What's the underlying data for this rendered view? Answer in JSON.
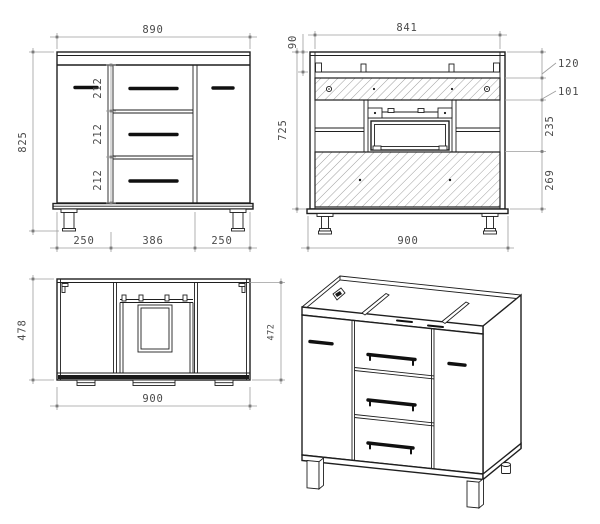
{
  "page": {
    "background": "#ffffff"
  },
  "style": {
    "line_color": "#1f1f1f",
    "dim_line_color": "#9c9c9c",
    "dim_text_color": "#4a4a4a",
    "handle_color": "#101010"
  },
  "views": {
    "front": {
      "name": "front-elevation",
      "dims": {
        "width_top": "890",
        "height_overall": "825",
        "drawer_1": "212",
        "drawer_2": "212",
        "drawer_3": "212",
        "bottom_left": "250",
        "bottom_center": "386",
        "bottom_right": "250"
      }
    },
    "rear": {
      "name": "rear-elevation",
      "dims": {
        "width_inner_top": "841",
        "top_rail": "90",
        "height_side": "725",
        "leader_1": "120",
        "leader_2": "101",
        "mid_section": "235",
        "lower_panel": "269",
        "width_overall": "900"
      }
    },
    "top": {
      "name": "plan-view",
      "dims": {
        "depth_overall": "478",
        "depth_inner": "472",
        "width_overall": "900"
      }
    },
    "iso": {
      "name": "isometric-view"
    }
  }
}
